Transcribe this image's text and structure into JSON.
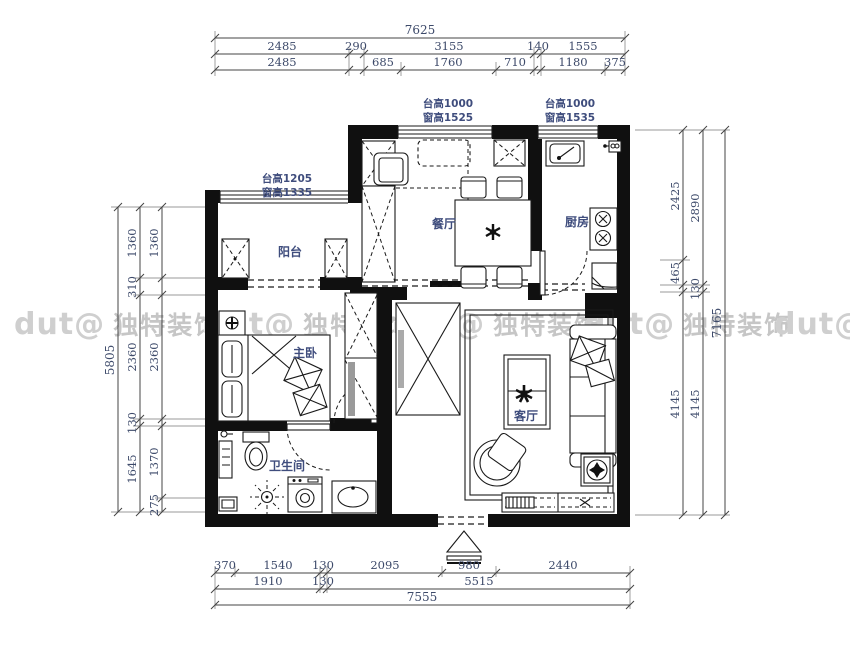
{
  "watermark": {
    "logo": "dut@",
    "text": "独特装饰"
  },
  "rooms": {
    "dining": "餐厅",
    "kitchen": "厨房",
    "balcony": "阳台",
    "master_bedroom": "主卧",
    "bathroom": "卫生间",
    "living": "客厅"
  },
  "annotations": {
    "balcony_window": {
      "line1": "台高1205",
      "line2": "窗高1335"
    },
    "dining_window": {
      "line1": "台高1000",
      "line2": "窗高1525"
    },
    "kitchen_window": {
      "line1": "台高1000",
      "line2": "窗高1535"
    }
  },
  "dimensions": {
    "top": {
      "total": "7625",
      "row2": [
        "2485",
        "290",
        "3155",
        "140",
        "1555"
      ],
      "row3": [
        "2485",
        "685",
        "1760",
        "710",
        "1180",
        "375"
      ]
    },
    "bottom": {
      "row1": [
        "370",
        "1540",
        "130",
        "2095",
        "980",
        "2440"
      ],
      "row2": [
        "1910",
        "130",
        "5515"
      ],
      "total": "7555"
    },
    "left": {
      "total": "5805",
      "col2": [
        "1360",
        "310",
        "2360",
        "130",
        "1645"
      ],
      "col3": [
        "1360",
        "2360",
        "1370",
        "275"
      ]
    },
    "right": {
      "inner": [
        "2425",
        "465",
        "4145"
      ],
      "middle": [
        "2890",
        "130",
        "4145"
      ],
      "total": "7165"
    }
  },
  "colors": {
    "wall": "#101010",
    "label": "#3f4d7d",
    "dim_text": "#3d4a6a",
    "watermark": "#c6c6c6"
  }
}
